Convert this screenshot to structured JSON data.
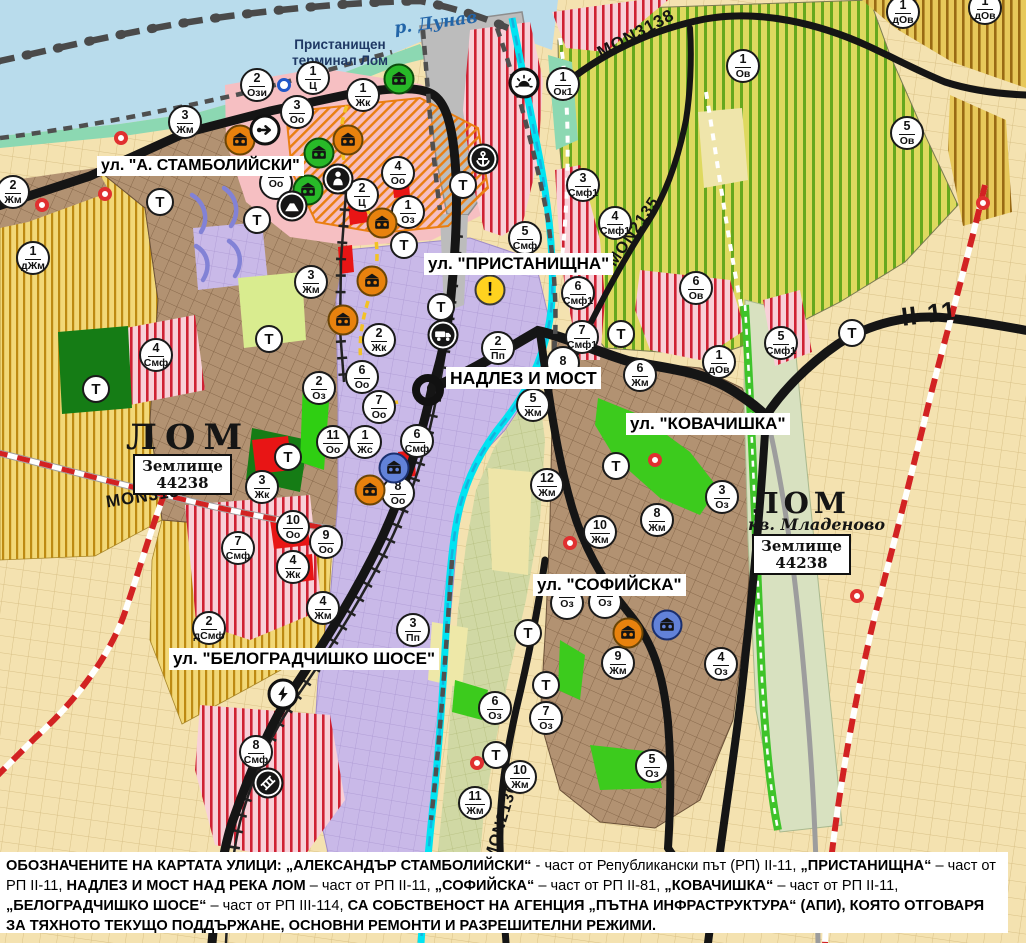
{
  "labels": {
    "river": {
      "text": "р. Дунав"
    },
    "terminal": {
      "line1": "Пристанищен",
      "line2": "терминал Лом"
    },
    "city_west": {
      "name": "ЛОМ",
      "plot_line1": "Землище",
      "plot_line2": "44238"
    },
    "city_east": {
      "name": "ЛОМ",
      "district": "кв. Младеново",
      "plot_line1": "Землище",
      "plot_line2": "44238"
    }
  },
  "street_labels": [
    {
      "text": "ул. \"А. СТАМБОЛИЙСКИ\"",
      "x": 97,
      "y": 156,
      "size": 16
    },
    {
      "text": "ул. \"ПРИСТАНИЩНА\"",
      "x": 424,
      "y": 253,
      "size": 17
    },
    {
      "text": "НАДЛЕЗ И МОСТ",
      "x": 446,
      "y": 367,
      "size": 17.5
    },
    {
      "text": "ул. \"КОВАЧИШКА\"",
      "x": 626,
      "y": 413,
      "size": 17
    },
    {
      "text": "ул. \"СОФИЙСКА\"",
      "x": 533,
      "y": 574,
      "size": 17
    },
    {
      "text": "ул. \"БЕЛОГРАДЧИШКО ШОСЕ\"",
      "x": 169,
      "y": 648,
      "size": 17
    }
  ],
  "road_labels": [
    {
      "text": "MON3139",
      "x": 148,
      "y": 496,
      "rot": -9,
      "size": 17
    },
    {
      "text": "MON3138",
      "x": 636,
      "y": 34,
      "rot": -28,
      "size": 17
    },
    {
      "text": "MON2135",
      "x": 634,
      "y": 232,
      "rot": -56,
      "size": 16
    },
    {
      "text": "MON2136",
      "x": 502,
      "y": 822,
      "rot": -73,
      "size": 16
    },
    {
      "text": "II-11",
      "x": 929,
      "y": 314,
      "rot": -7,
      "size": 26
    }
  ],
  "zone_markers": [
    {
      "n": "2",
      "code": "Ози",
      "x": 257,
      "y": 85
    },
    {
      "n": "1",
      "code": "Ц",
      "x": 313,
      "y": 78
    },
    {
      "n": "3",
      "code": "Оо",
      "x": 297,
      "y": 112
    },
    {
      "n": "1",
      "code": "Жк",
      "x": 363,
      "y": 95
    },
    {
      "n": "3",
      "code": "Жм",
      "x": 185,
      "y": 122
    },
    {
      "n": "2",
      "code": "Жм",
      "x": 13,
      "y": 192
    },
    {
      "n": "1",
      "code": "дЖм",
      "x": 33,
      "y": 258
    },
    {
      "n": "4",
      "code": "Оо",
      "x": 398,
      "y": 173
    },
    {
      "n": "2",
      "code": "Ц",
      "x": 362,
      "y": 195
    },
    {
      "n": "1",
      "code": "Оз",
      "x": 408,
      "y": 212
    },
    {
      "n": "",
      "code": "Оо",
      "x": 276,
      "y": 183
    },
    {
      "n": "3",
      "code": "Жм",
      "x": 311,
      "y": 282
    },
    {
      "n": "2",
      "code": "Жк",
      "x": 379,
      "y": 340
    },
    {
      "n": "2",
      "code": "Оз",
      "x": 319,
      "y": 388
    },
    {
      "n": "6",
      "code": "Оо",
      "x": 362,
      "y": 377
    },
    {
      "n": "7",
      "code": "Оо",
      "x": 379,
      "y": 407
    },
    {
      "n": "11",
      "code": "Оо",
      "x": 333,
      "y": 442
    },
    {
      "n": "1",
      "code": "Жс",
      "x": 365,
      "y": 442
    },
    {
      "n": "3",
      "code": "Жк",
      "x": 262,
      "y": 487
    },
    {
      "n": "8",
      "code": "Оо",
      "x": 398,
      "y": 493
    },
    {
      "n": "6",
      "code": "Смф",
      "x": 417,
      "y": 441
    },
    {
      "n": "4",
      "code": "Смф",
      "x": 156,
      "y": 355
    },
    {
      "n": "5",
      "code": "Смф",
      "x": 525,
      "y": 238
    },
    {
      "n": "2",
      "code": "Пп",
      "x": 498,
      "y": 348
    },
    {
      "n": "3",
      "code": "Смф1",
      "x": 583,
      "y": 185
    },
    {
      "n": "4",
      "code": "Смф1",
      "x": 615,
      "y": 223
    },
    {
      "n": "6",
      "code": "Смф1",
      "x": 578,
      "y": 293
    },
    {
      "n": "7",
      "code": "Смф1",
      "x": 582,
      "y": 337
    },
    {
      "n": "8",
      "code": "",
      "x": 563,
      "y": 363
    },
    {
      "n": "5",
      "code": "Жм",
      "x": 533,
      "y": 405
    },
    {
      "n": "1",
      "code": "Ок1",
      "x": 563,
      "y": 84
    },
    {
      "n": "1",
      "code": "Ов",
      "x": 743,
      "y": 66
    },
    {
      "n": "5",
      "code": "Ов",
      "x": 907,
      "y": 133
    },
    {
      "n": "1",
      "code": "дОв",
      "x": 903,
      "y": 12
    },
    {
      "n": "1",
      "code": "дОв",
      "x": 985,
      "y": 8
    },
    {
      "n": "6",
      "code": "Ов",
      "x": 696,
      "y": 288
    },
    {
      "n": "5",
      "code": "Смф1",
      "x": 781,
      "y": 343
    },
    {
      "n": "1",
      "code": "дОв",
      "x": 719,
      "y": 362
    },
    {
      "n": "6",
      "code": "Жм",
      "x": 640,
      "y": 375
    },
    {
      "n": "12",
      "code": "Жм",
      "x": 547,
      "y": 485
    },
    {
      "n": "10",
      "code": "Жм",
      "x": 600,
      "y": 532
    },
    {
      "n": "8",
      "code": "Жм",
      "x": 657,
      "y": 520
    },
    {
      "n": "3",
      "code": "Оз",
      "x": 722,
      "y": 497
    },
    {
      "n": "7",
      "code": "Смф",
      "x": 238,
      "y": 548
    },
    {
      "n": "10",
      "code": "Оо",
      "x": 293,
      "y": 527
    },
    {
      "n": "9",
      "code": "Оо",
      "x": 326,
      "y": 542
    },
    {
      "n": "4",
      "code": "Жк",
      "x": 293,
      "y": 567
    },
    {
      "n": "4",
      "code": "Жм",
      "x": 323,
      "y": 608
    },
    {
      "n": "2",
      "code": "дСмф",
      "x": 209,
      "y": 628
    },
    {
      "n": "3",
      "code": "Пп",
      "x": 413,
      "y": 630
    },
    {
      "n": "8",
      "code": "Смф",
      "x": 256,
      "y": 752
    },
    {
      "n": "6",
      "code": "Оз",
      "x": 495,
      "y": 708
    },
    {
      "n": "7",
      "code": "Оз",
      "x": 546,
      "y": 718
    },
    {
      "n": "",
      "code": "Оз",
      "x": 567,
      "y": 603
    },
    {
      "n": "",
      "code": "Оз",
      "x": 605,
      "y": 602
    },
    {
      "n": "9",
      "code": "Жм",
      "x": 618,
      "y": 663
    },
    {
      "n": "10",
      "code": "Жм",
      "x": 520,
      "y": 777
    },
    {
      "n": "11",
      "code": "Жм",
      "x": 475,
      "y": 803
    },
    {
      "n": "5",
      "code": "Оз",
      "x": 652,
      "y": 766
    },
    {
      "n": "4",
      "code": "Оз",
      "x": 721,
      "y": 664
    }
  ],
  "transport_markers": {
    "label": "Т",
    "positions": [
      [
        160,
        202
      ],
      [
        257,
        220
      ],
      [
        96,
        389
      ],
      [
        269,
        339
      ],
      [
        288,
        457
      ],
      [
        404,
        245
      ],
      [
        441,
        307
      ],
      [
        621,
        334
      ],
      [
        463,
        185
      ],
      [
        616,
        466
      ],
      [
        528,
        633
      ],
      [
        546,
        685
      ],
      [
        496,
        755
      ],
      [
        852,
        333
      ]
    ]
  },
  "icon_markers": [
    {
      "type": "culture-orange",
      "x": 240,
      "y": 140
    },
    {
      "type": "culture-orange",
      "x": 348,
      "y": 140
    },
    {
      "type": "culture-orange",
      "x": 382,
      "y": 223
    },
    {
      "type": "culture-orange",
      "x": 372,
      "y": 281
    },
    {
      "type": "culture-orange",
      "x": 343,
      "y": 320
    },
    {
      "type": "culture-orange",
      "x": 370,
      "y": 490
    },
    {
      "type": "culture-orange",
      "x": 628,
      "y": 633
    },
    {
      "type": "culture-green",
      "x": 399,
      "y": 79
    },
    {
      "type": "culture-green",
      "x": 319,
      "y": 153
    },
    {
      "type": "culture-green",
      "x": 308,
      "y": 190
    },
    {
      "type": "culture-blue",
      "x": 394,
      "y": 468
    },
    {
      "type": "culture-blue",
      "x": 667,
      "y": 625
    },
    {
      "type": "arrow",
      "x": 265,
      "y": 130
    },
    {
      "type": "statue",
      "x": 338,
      "y": 179
    },
    {
      "type": "mountain",
      "x": 292,
      "y": 206
    },
    {
      "type": "anchor",
      "x": 483,
      "y": 159
    },
    {
      "type": "sunrise",
      "x": 524,
      "y": 83
    },
    {
      "type": "warning",
      "x": 490,
      "y": 290
    },
    {
      "type": "truck",
      "x": 443,
      "y": 335
    },
    {
      "type": "lightning",
      "x": 283,
      "y": 694
    },
    {
      "type": "railcross",
      "x": 268,
      "y": 783
    },
    {
      "type": "bluering",
      "x": 284,
      "y": 85
    }
  ],
  "red_dot_positions": [
    [
      121,
      138
    ],
    [
      105,
      194
    ],
    [
      42,
      205
    ],
    [
      655,
      460
    ],
    [
      570,
      543
    ],
    [
      477,
      763
    ],
    [
      983,
      203
    ],
    [
      857,
      596
    ]
  ],
  "footer": {
    "segments": [
      {
        "bold": true,
        "text": "ОБОЗНАЧЕНИТЕ НА КАРТАТА УЛИЦИ: „АЛЕКСАНДЪР СТАМБОЛИЙСКИ“"
      },
      {
        "bold": false,
        "text": " - част от Републикански път (РП) II-11, "
      },
      {
        "bold": true,
        "text": "„ПРИСТАНИЩНА“"
      },
      {
        "bold": false,
        "text": " – част от РП II-11, "
      },
      {
        "bold": true,
        "text": "НАДЛЕЗ И МОСТ НАД РЕКА ЛОМ"
      },
      {
        "bold": false,
        "text": " – част от РП II-11, "
      },
      {
        "bold": true,
        "text": "„СОФИЙСКА“"
      },
      {
        "bold": false,
        "text": " – част от РП II-81, "
      },
      {
        "bold": true,
        "text": "„КОВАЧИШКА“"
      },
      {
        "bold": false,
        "text": " – част от РП II-11, "
      },
      {
        "bold": true,
        "text": "„БЕЛОГРАДЧИШКО ШОСЕ“"
      },
      {
        "bold": false,
        "text": " – част от РП III-114, "
      },
      {
        "bold": true,
        "text": "СА СОБСТВЕНОСТ НА АГЕНЦИЯ „ПЪТНА ИНФРАСТРУКТУРА“ (АПИ), КОЯТО ОТГОВАРЯ ЗА ТЯХНОТО ТЕКУЩО ПОДДЪРЖАНЕ, ОСНОВНИ РЕМОНТИ И РАЗРЕШИТЕЛНИ РЕЖИМИ."
      }
    ]
  },
  "colors": {
    "water": "#b9dcec",
    "residential_brown": "#b29272",
    "farmland_yellow": "#f2d877",
    "farmland_stripe": "#bd8a12",
    "vineyard_green": "#66a81e",
    "mixed_zone_red": "#cf2133",
    "industrial_purple": "#c9b9e8",
    "port_gray": "#bcbcbc",
    "park_green": "#2fcf12",
    "river_cyan": "#00e4f2",
    "boundary_red": "#d22222",
    "road_black": "#151515",
    "marker_orange": "#e8820e",
    "marker_green": "#28b928",
    "marker_blue": "#6282d8",
    "warning_yellow": "#ffd21f"
  }
}
